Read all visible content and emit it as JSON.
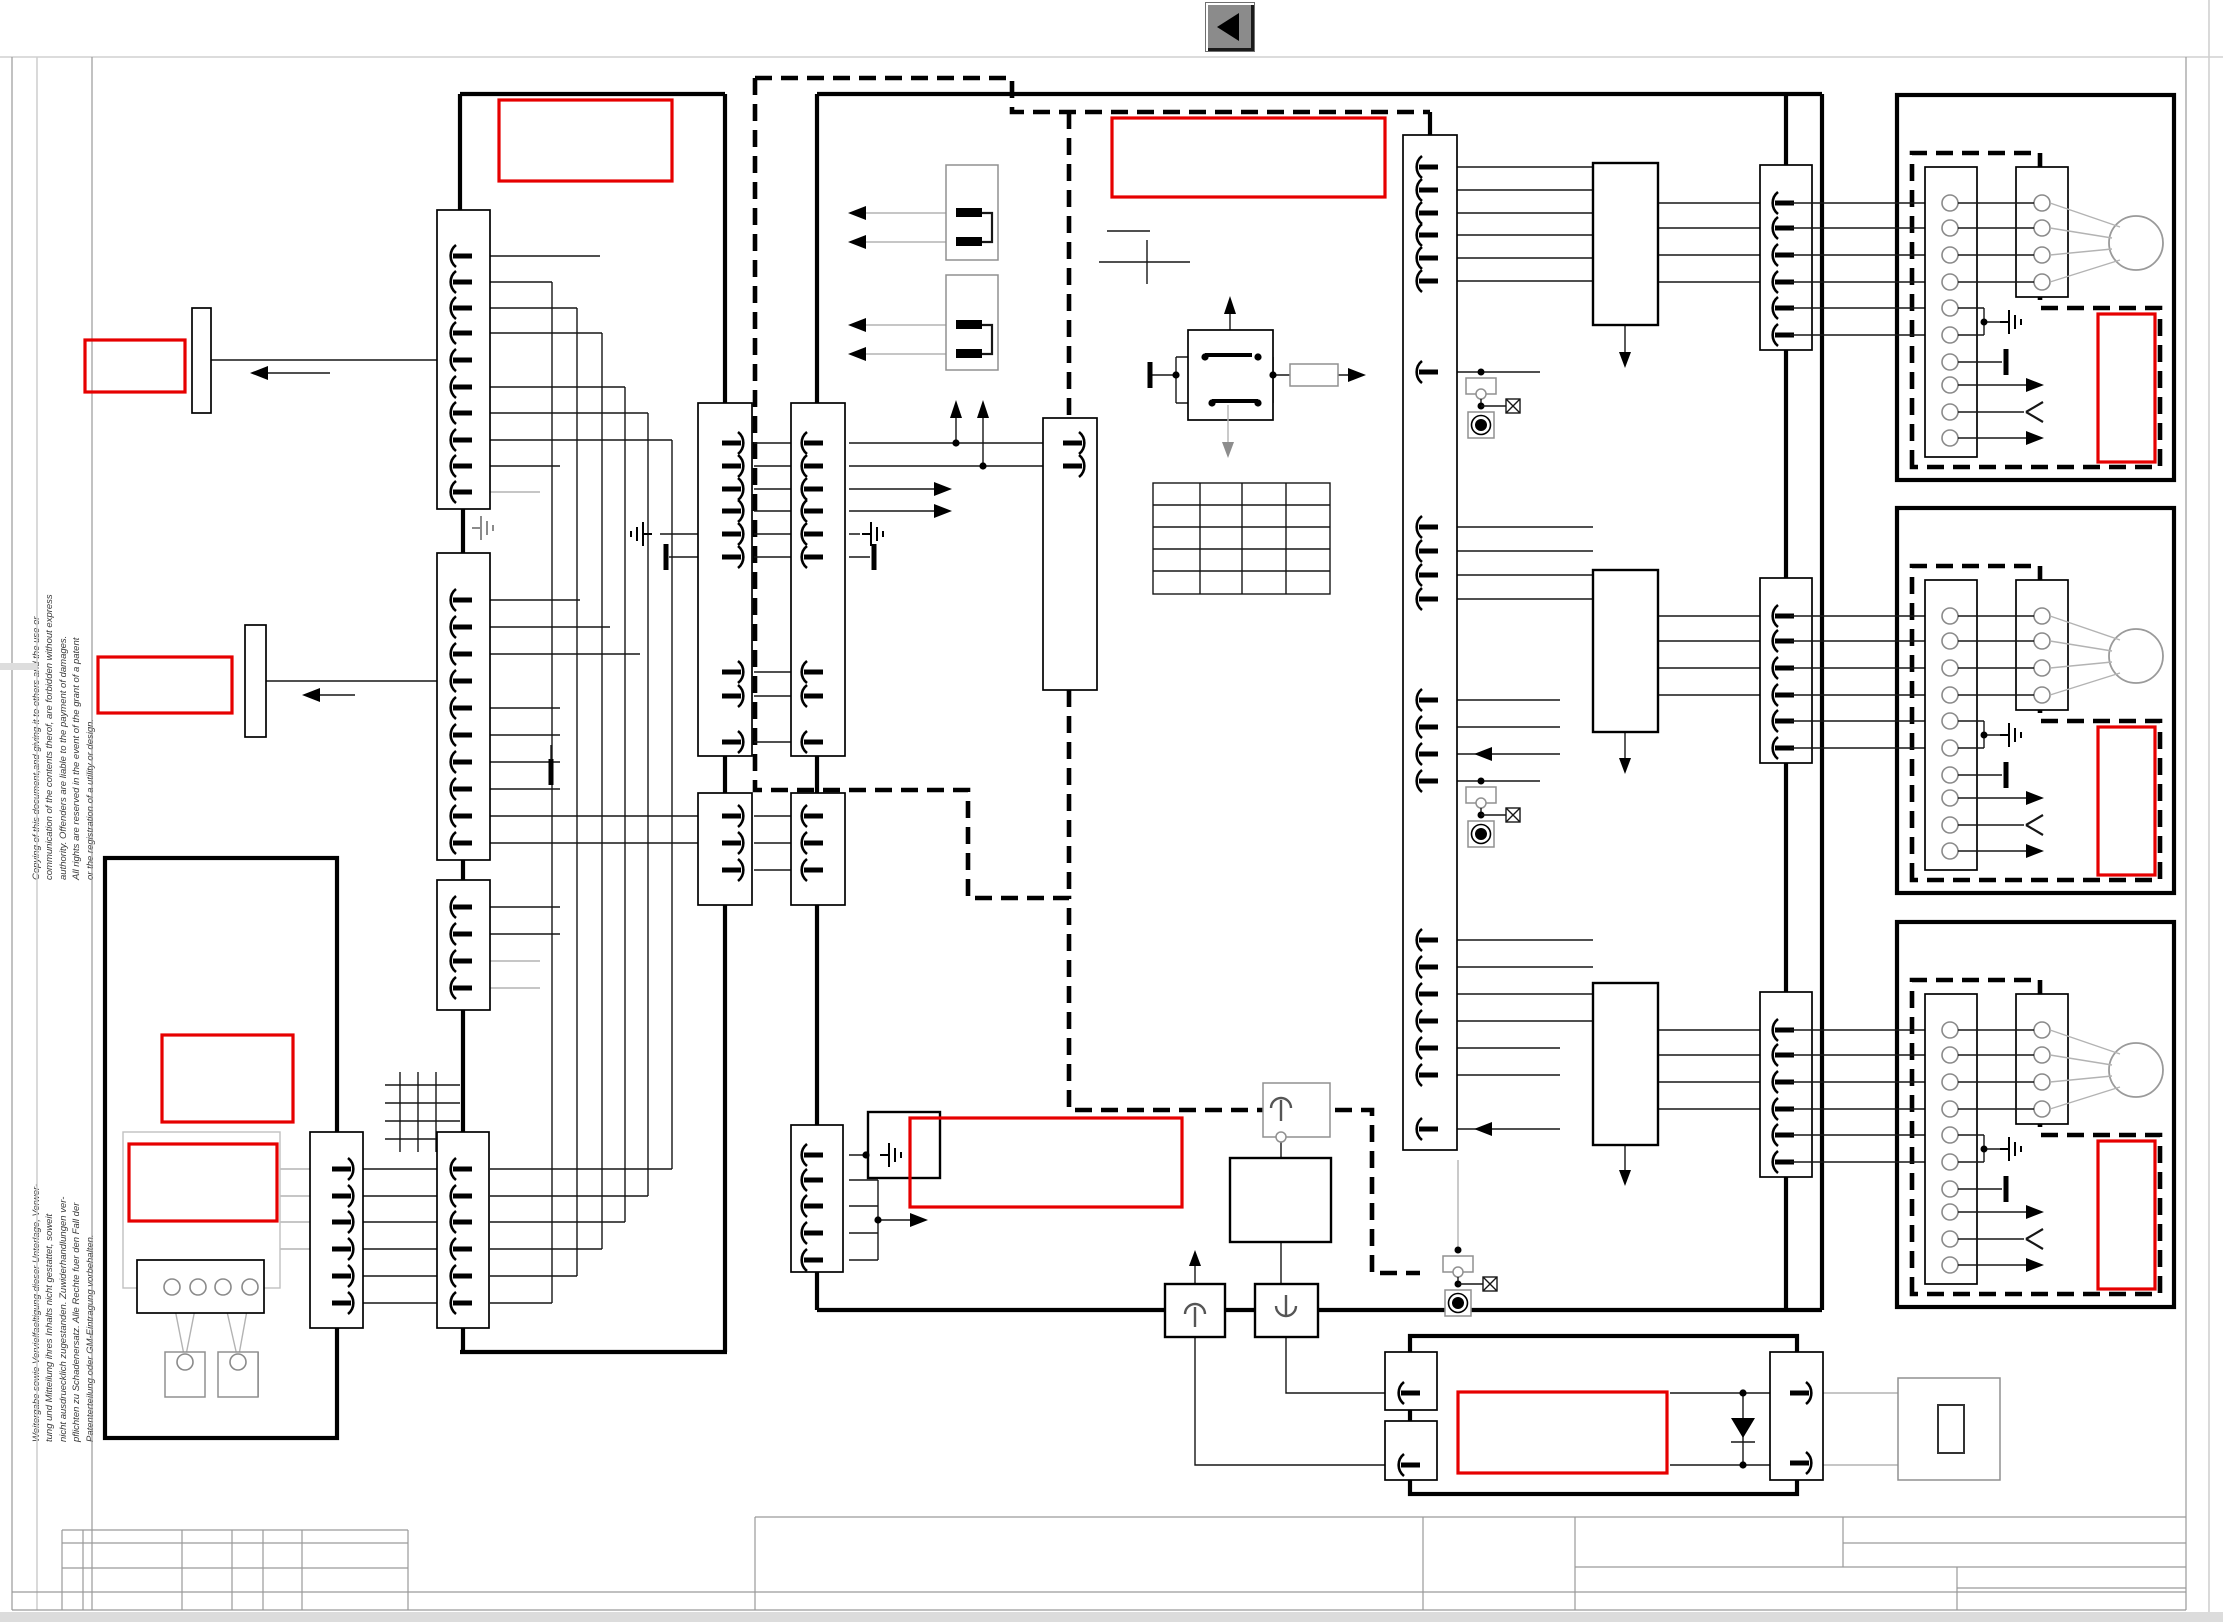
{
  "app": {
    "back_button": {
      "icon": "back-arrow-icon",
      "shape": "left-pointing black triangle on gray square"
    }
  },
  "colors": {
    "highlight": "#e60000",
    "ink": "#3a3a3a",
    "line": "#000000",
    "muted": "#b3b3b3",
    "frame": "#9a9a9a",
    "button": "#8b8b8b",
    "page": "#ffffff"
  },
  "legal": {
    "english": "Copying of this document,and giving it to others and the use or\ncommunication of the contents therof, are forbidden without express\nauthority. Offenders are liable to the payment of damages.\nAll rights are reserved in the event of the grant of a patent\nor the registration of a utility or design.",
    "german": "Weitergabe sowie Vervielfaeltigung dieser Unterlage, Verwer-\ntung und Mitteilung ihres Inhalts nicht gestattet, soweit\nnicht ausdruecklich zugestanden. Zuwiderhandlungen ver-\npflichten zu Schadenersatz. Alle Rechte fuer den Fall der\nPatenterteilung oder GM-Eintragung vorbehalten."
  },
  "schematic": {
    "kind": "vehicle wiring / harness diagram sheet",
    "redacted_label_regions": 11,
    "fan_motor_units": 3,
    "ecu_blocks": 3,
    "connector_strip_columns": 9,
    "fuse_link_blocks": 2,
    "relay_blocks": 1,
    "table_grid": {
      "columns": 4,
      "rows": 5,
      "cells_text": ""
    },
    "symbols": [
      "motor-icon",
      "earth-ground-icon",
      "chassis-ground-icon",
      "fuse-icon",
      "diode-icon",
      "current-sensor-icon",
      "indicator-lamp-icon",
      "crossed-lamp-icon",
      "arrow-icon"
    ],
    "title_block": {
      "text": ""
    }
  }
}
